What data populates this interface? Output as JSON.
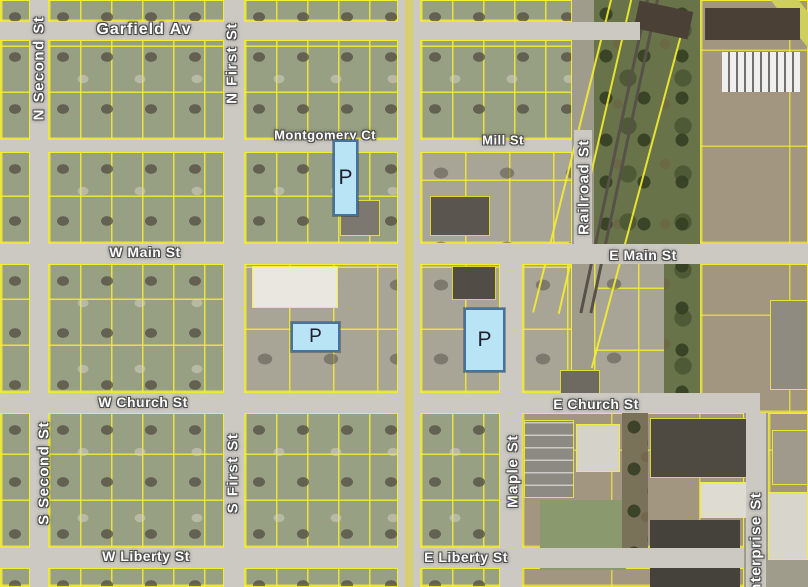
{
  "map": {
    "street_labels": [
      {
        "id": "garfield-av",
        "label": "Garfield Av",
        "orientation": "horizontal"
      },
      {
        "id": "n-second-st",
        "label": "N Second St",
        "orientation": "vertical"
      },
      {
        "id": "n-first-st",
        "label": "N First St",
        "orientation": "vertical"
      },
      {
        "id": "montgomery-ct",
        "label": "Montgomery Ct",
        "orientation": "horizontal"
      },
      {
        "id": "mill-st",
        "label": "Mill St",
        "orientation": "horizontal"
      },
      {
        "id": "railroad-st",
        "label": "Railroad St",
        "orientation": "vertical"
      },
      {
        "id": "w-main-st",
        "label": "W Main St",
        "orientation": "horizontal"
      },
      {
        "id": "e-main-st",
        "label": "E Main St",
        "orientation": "horizontal"
      },
      {
        "id": "w-church-st",
        "label": "W Church St",
        "orientation": "horizontal"
      },
      {
        "id": "e-church-st",
        "label": "E Church St",
        "orientation": "horizontal"
      },
      {
        "id": "s-second-st",
        "label": "S Second St",
        "orientation": "vertical"
      },
      {
        "id": "s-first-st",
        "label": "S First St",
        "orientation": "vertical"
      },
      {
        "id": "maple-st",
        "label": "Maple St",
        "orientation": "vertical"
      },
      {
        "id": "w-liberty-st",
        "label": "W Liberty St",
        "orientation": "horizontal"
      },
      {
        "id": "e-liberty-st",
        "label": "E Liberty St",
        "orientation": "horizontal"
      },
      {
        "id": "enterprise-st",
        "label": "Enterprise St",
        "orientation": "vertical"
      }
    ],
    "parking_markers": [
      {
        "label": "P"
      },
      {
        "label": "P"
      },
      {
        "label": "P"
      }
    ],
    "colors": {
      "parcel_line": "#f6ee2e",
      "marker_fill": "#b9e4f6",
      "marker_border": "#44749e",
      "label_text": "#fdfdfd",
      "road": "#cbc9c2",
      "highway_stripe": "#d8cf6e"
    }
  }
}
